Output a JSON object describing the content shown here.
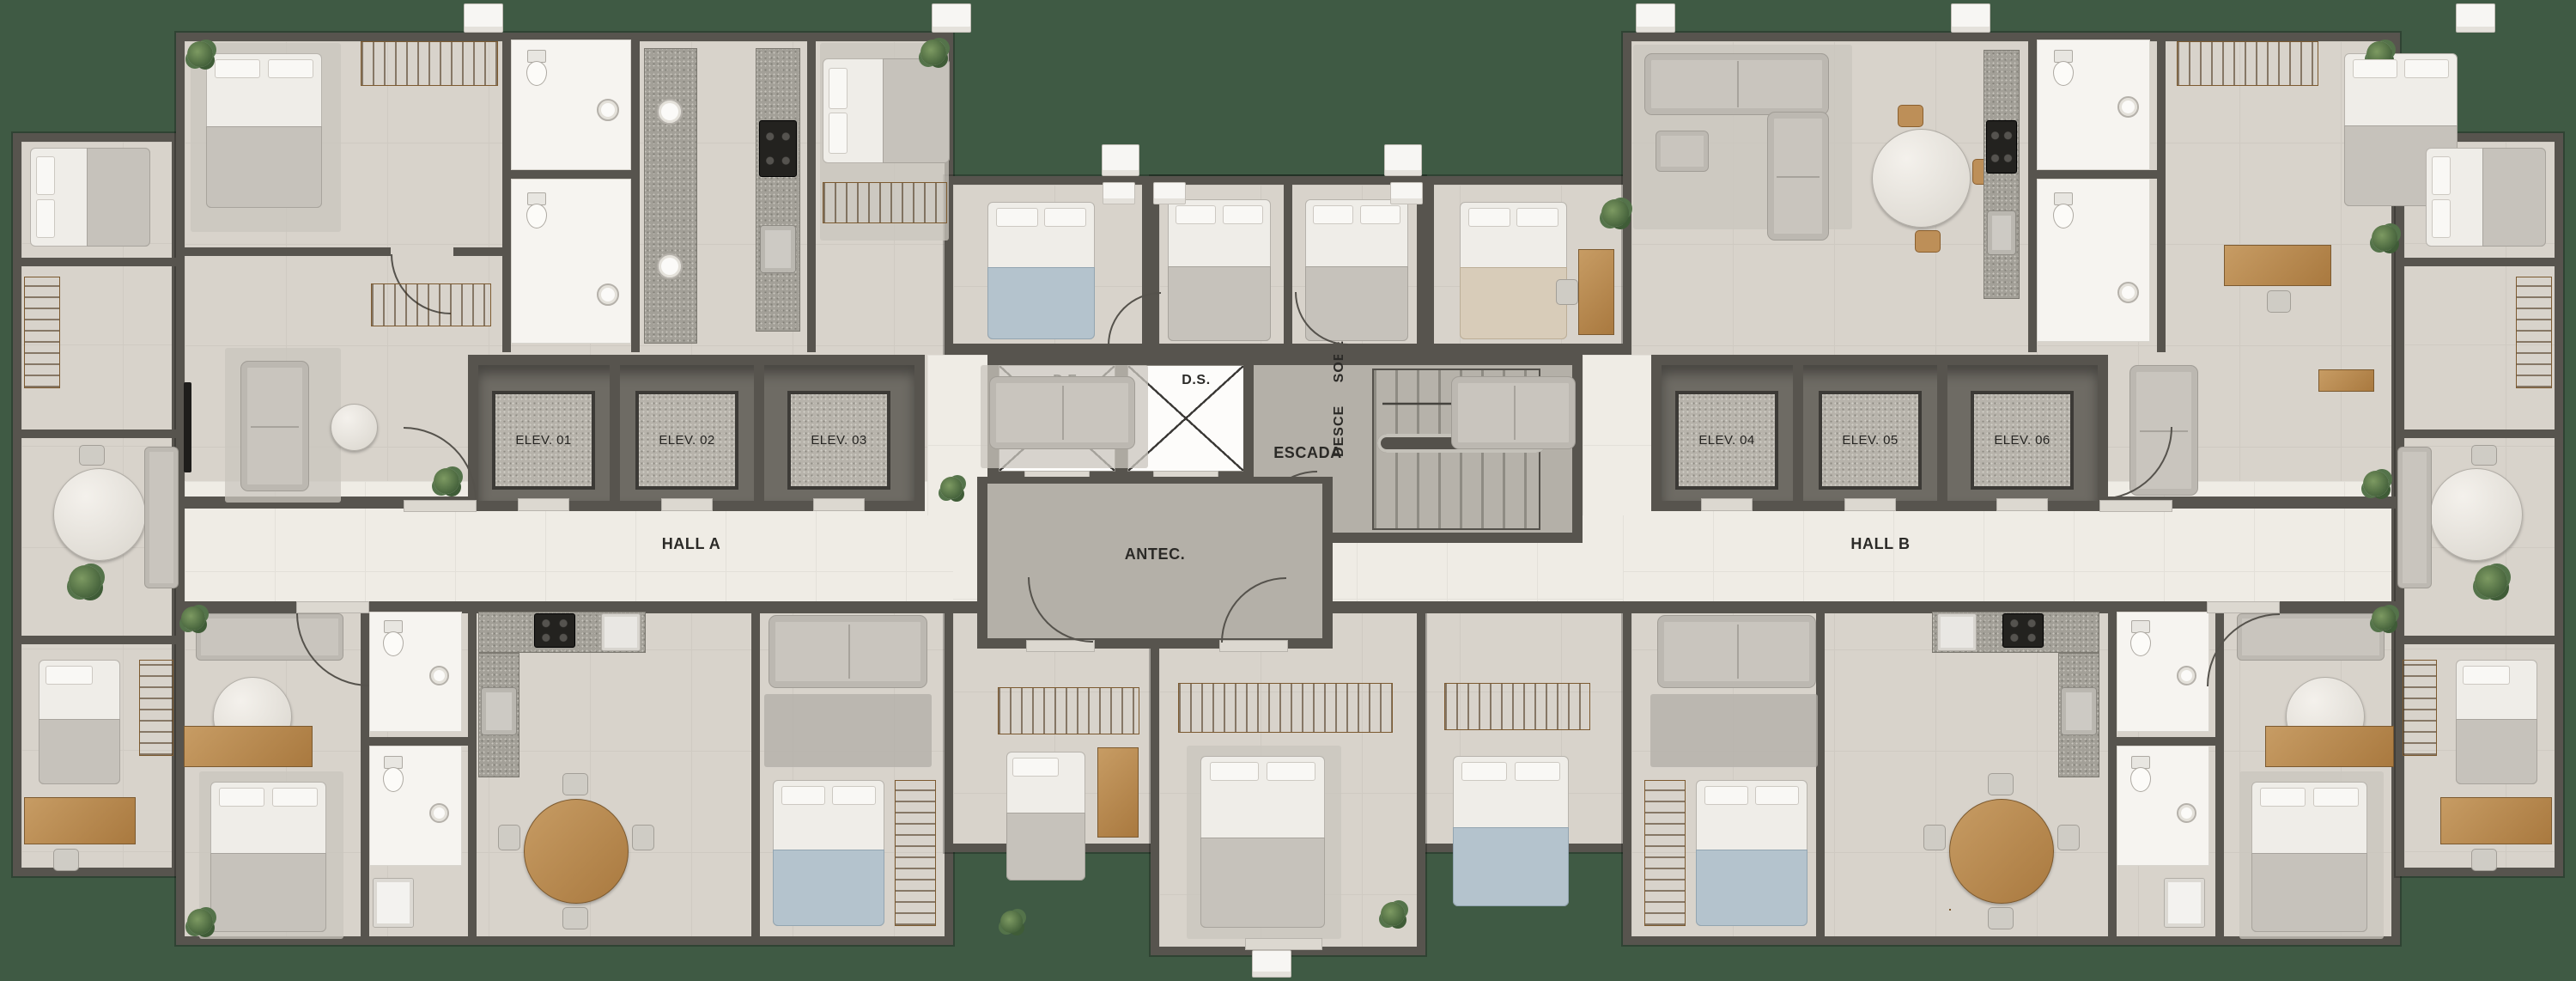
{
  "palette": {
    "bg": "#3f5a44",
    "wall": "#57544e",
    "floor": "#d8d3cb",
    "floor-light": "#efece5",
    "floor-core": "#b4b0a8",
    "granite": "#a3a098",
    "granite-dark": "#4e4b46",
    "wood": "#b98a54",
    "white": "#f6f4f0",
    "text": "#2b2a27",
    "sofa": "#c9c5be",
    "plant": "#5d7a4c"
  },
  "labels": {
    "de": "D.E.",
    "ds": "D.S.",
    "escada": "ESCADA",
    "sobe": "SOBE",
    "desce": "DESCE",
    "antec": "ANTEC.",
    "hall_a": "HALL A",
    "hall_b": "HALL B"
  },
  "elevators": [
    "ELEV. 01",
    "ELEV. 02",
    "ELEV. 03",
    "ELEV. 04",
    "ELEV. 05",
    "ELEV. 06"
  ]
}
